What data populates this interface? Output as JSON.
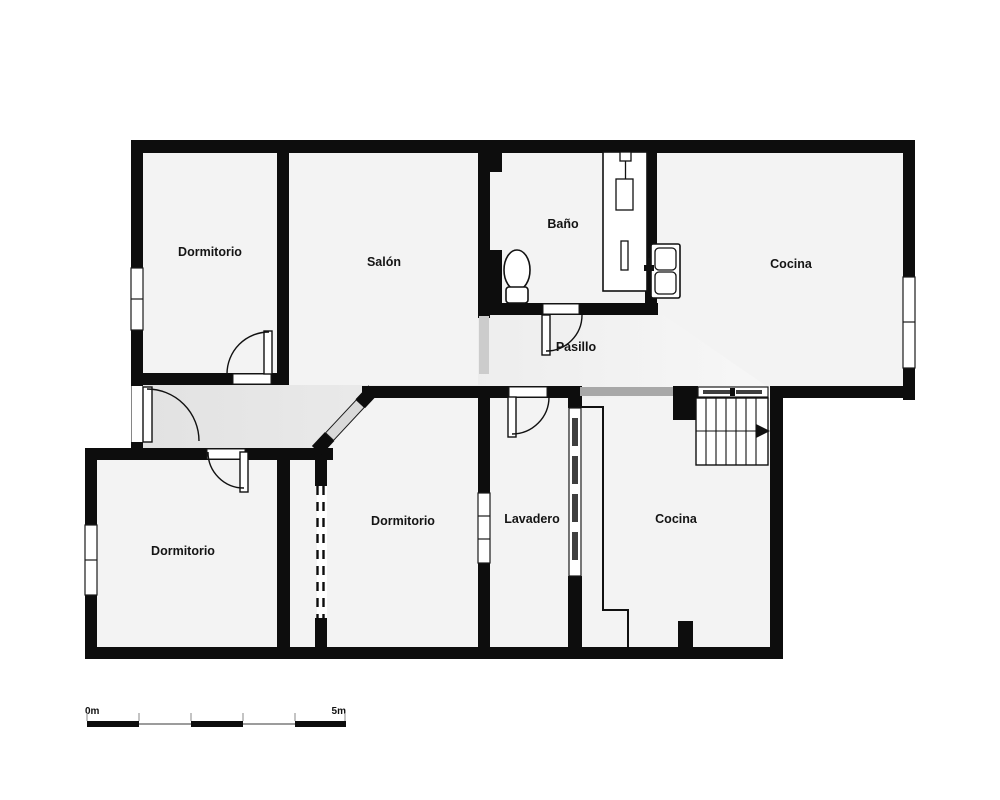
{
  "floorplan": {
    "type": "residential-floor-plan",
    "rooms": [
      {
        "id": "dormitorio-top-left",
        "label": "Dormitorio"
      },
      {
        "id": "salon",
        "label": "Salón"
      },
      {
        "id": "bano",
        "label": "Baño"
      },
      {
        "id": "cocina-top",
        "label": "Cocina"
      },
      {
        "id": "pasillo",
        "label": "Pasillo"
      },
      {
        "id": "dormitorio-bottom-left",
        "label": "Dormitorio"
      },
      {
        "id": "dormitorio-middle",
        "label": "Dormitorio"
      },
      {
        "id": "lavadero",
        "label": "Lavadero"
      },
      {
        "id": "cocina-bottom",
        "label": "Cocina"
      }
    ],
    "fixtures": [
      "toilet",
      "shower-column",
      "double-sink",
      "kitchen-counter",
      "staircase"
    ],
    "scale_bar": {
      "start_label": "0m",
      "end_label": "5m"
    },
    "colors": {
      "wall": "#0d0d0d",
      "floor": "#f3f3f3",
      "hall_start": "#e2e2e2",
      "hall_end": "#f7f7f7",
      "glazing_dark": "#3f3f3f",
      "glazing_light": "#d9d9d9",
      "open_boundary": "#a8a8a8",
      "open_boundary_light": "#cccccc",
      "scale_gray": "#9c9c9c",
      "paper": "#ffffff"
    }
  }
}
